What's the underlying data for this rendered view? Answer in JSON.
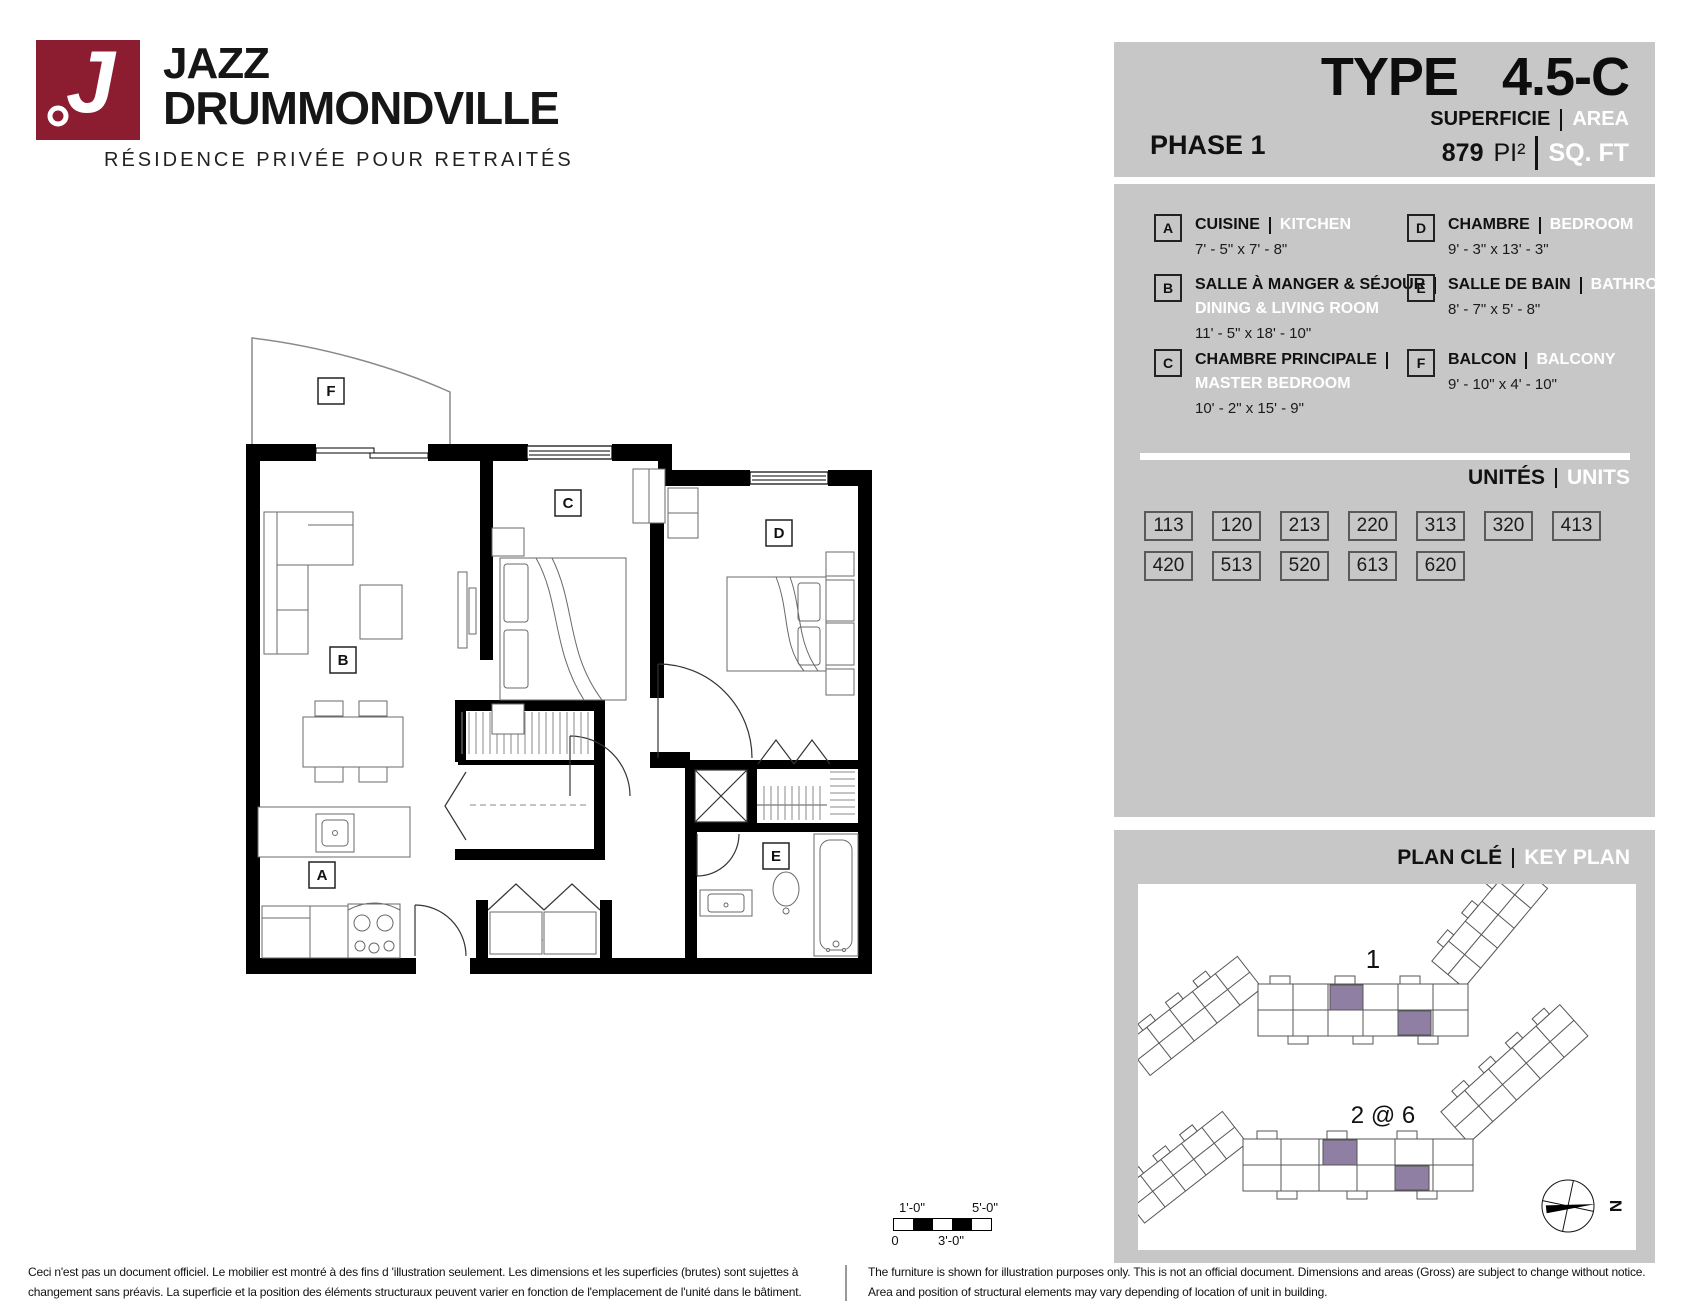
{
  "logo": {
    "monogram": "J",
    "brand_line1": "JAZZ",
    "brand_line2": "DRUMMONDVILLE",
    "tagline": "RÉSIDENCE PRIVÉE POUR RETRAITÉS",
    "brand_color": "#8C1C30"
  },
  "header": {
    "phase": "PHASE 1",
    "type_label": "TYPE",
    "type_value": "4.5-C",
    "area_label_fr": "SUPERFICIE",
    "area_label_en": "AREA",
    "area_value": "879",
    "area_unit_fr": "PI²",
    "area_unit_en": "SQ. FT"
  },
  "legend": {
    "items": [
      {
        "key": "A",
        "fr": "CUISINE",
        "en": "KITCHEN",
        "dims": "7' - 5\" x 7' - 8\""
      },
      {
        "key": "B",
        "fr": "SALLE À MANGER & SÉJOUR",
        "en": "DINING & LIVING ROOM",
        "dims": "11' - 5\" x 18' - 10\""
      },
      {
        "key": "C",
        "fr": "CHAMBRE PRINCIPALE",
        "en": "MASTER BEDROOM",
        "dims": "10' - 2\" x 15' - 9\""
      },
      {
        "key": "D",
        "fr": "CHAMBRE",
        "en": "BEDROOM",
        "dims": "9' - 3\" x 13' - 3\""
      },
      {
        "key": "E",
        "fr": "SALLE DE BAIN",
        "en": "BATHROOM",
        "dims": "8' - 7\" x 5' - 8\""
      },
      {
        "key": "F",
        "fr": "BALCON",
        "en": "BALCONY",
        "dims": "9' - 10\" x 4' - 10\""
      }
    ]
  },
  "units": {
    "title_fr": "UNITÉS",
    "title_en": "UNITS",
    "row1": [
      "113",
      "120",
      "213",
      "220",
      "313",
      "320",
      "413"
    ],
    "row2": [
      "420",
      "513",
      "520",
      "613",
      "620"
    ]
  },
  "key_plan": {
    "title_fr": "PLAN CLÉ",
    "title_en": "KEY PLAN",
    "building1_label": "1",
    "building2_label": "2 @ 6",
    "north_label": "N",
    "highlight_color": "#8E7FA3"
  },
  "floor_plan": {
    "labels": {
      "A": "A",
      "B": "B",
      "C": "C",
      "D": "D",
      "E": "E",
      "F": "F"
    }
  },
  "scale_bar": {
    "top_left": "1'-0\"",
    "top_right": "5'-0\"",
    "bottom_left": "0",
    "bottom_mid": "3'-0\""
  },
  "disclaimers": {
    "fr_line1": "Ceci n'est pas un document officiel.  Le mobilier est montré à des fins d 'illustration seulement.  Les dimensions et les superficies (brutes) sont sujettes à",
    "fr_line2": "changement sans préavis. La superficie et la position des éléments structuraux peuvent varier en fonction de l'emplacement de l'unité dans le bâtiment.",
    "en_line1": "The furniture is shown for illustration purposes only.  This is not an official document.  Dimensions and areas (Gross) are subject to change without notice.",
    "en_line2": "Area and position of structural elements may vary depending of location of unit in building."
  }
}
